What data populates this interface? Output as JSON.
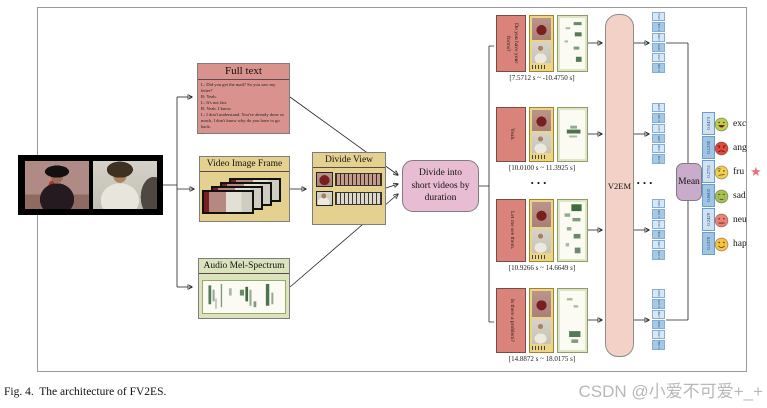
{
  "caption": "Fig. 4.  The architecture of FV2ES.",
  "watermark": "CSDN @小爱不可爱+_+",
  "ellipsis": "...",
  "full_text_box": {
    "title": "Full text",
    "lines": [
      "L: Did you get the mail? So you saw my letter?",
      "R: Yeah.",
      "L: It's not fair.",
      "R: Yeah.  I know.",
      "L: I don't understand.  You've already done so much, I don't know why do you have to go back.",
      "..."
    ]
  },
  "video_frame_box": {
    "title": "Video Image Frame"
  },
  "audio_box": {
    "title": "Audio Mel-Spectrum"
  },
  "divide_view_box": {
    "title": "Divide View"
  },
  "divide_node": {
    "label": "Divide into short videos by duration"
  },
  "v2em": {
    "label": "V2EM"
  },
  "mean": {
    "label": "Mean"
  },
  "segments": [
    {
      "text": "Do you have your forms?",
      "timestamp": "[7.5712 s ~ -10.4750 s]"
    },
    {
      "text": "Yeah.",
      "timestamp": "[10.0100 s ~ 11.3925 s]"
    },
    {
      "text": "Let me see them.",
      "timestamp": "[10.9266 s ~ 14.6649 s]"
    },
    {
      "text": "Is there a problem?",
      "timestamp": "[14.8872 s ~ 18.0175 s]"
    }
  ],
  "segment_vectors": [
    {
      "values": [
        "0.0512",
        "0.1342",
        "0.2966",
        "0.0703",
        "0.2531",
        "0.1946"
      ]
    },
    {
      "values": [
        "0.0389",
        "0.1057",
        "0.2214",
        "0.0651",
        "0.3348",
        "0.2341"
      ]
    },
    {
      "values": [
        "0.0624",
        "0.1283",
        "0.3102",
        "0.0542",
        "0.2667",
        "0.1782"
      ]
    },
    {
      "values": [
        "0.0418",
        "0.1196",
        "0.2845",
        "0.0587",
        "0.2910",
        "0.2044"
      ]
    }
  ],
  "output_vector": {
    "values": [
      "0.0473",
      "0.1230",
      "0.2751",
      "0.0602",
      "0.2429",
      "0.1370"
    ]
  },
  "emotions": [
    {
      "label": "exc",
      "color": "#bfce4a"
    },
    {
      "label": "ang",
      "color": "#e0493b"
    },
    {
      "label": "fru",
      "color": "#f0cf4e"
    },
    {
      "label": "sad",
      "color": "#a9c24c"
    },
    {
      "label": "neu",
      "color": "#ea8374"
    },
    {
      "label": "hap",
      "color": "#f5c242"
    }
  ],
  "colors": {
    "star": "#e9707e"
  }
}
